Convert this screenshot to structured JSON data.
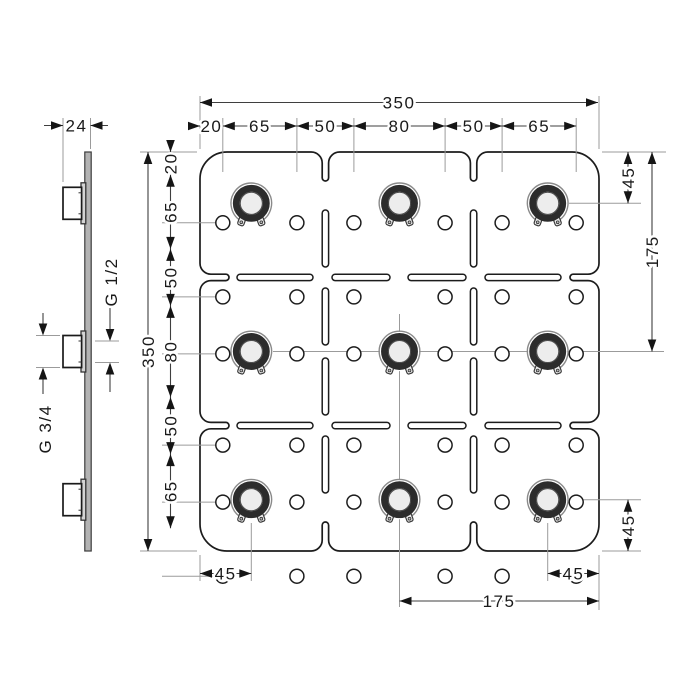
{
  "palette": {
    "ink": "#1c1c1c",
    "guide_grey": "#9b9b9b",
    "metal_grey": "#b3b3b3",
    "ring_dark": "#2c2c2c"
  },
  "front_view": {
    "overall": {
      "width": "350",
      "height": "350"
    },
    "top_chain": [
      "20",
      "65",
      "50",
      "80",
      "50",
      "65"
    ],
    "left_chain": [
      "20",
      "65",
      "50",
      "80",
      "50",
      "65"
    ],
    "right_offsets": {
      "top": "45",
      "middle": "175",
      "bottom": "45"
    },
    "bottom_offsets": {
      "left": "45",
      "middle": "175",
      "right": "45"
    }
  },
  "side_view": {
    "depth": "24",
    "thread_upper": "G 1/2",
    "thread_lower": "G 3/4"
  }
}
